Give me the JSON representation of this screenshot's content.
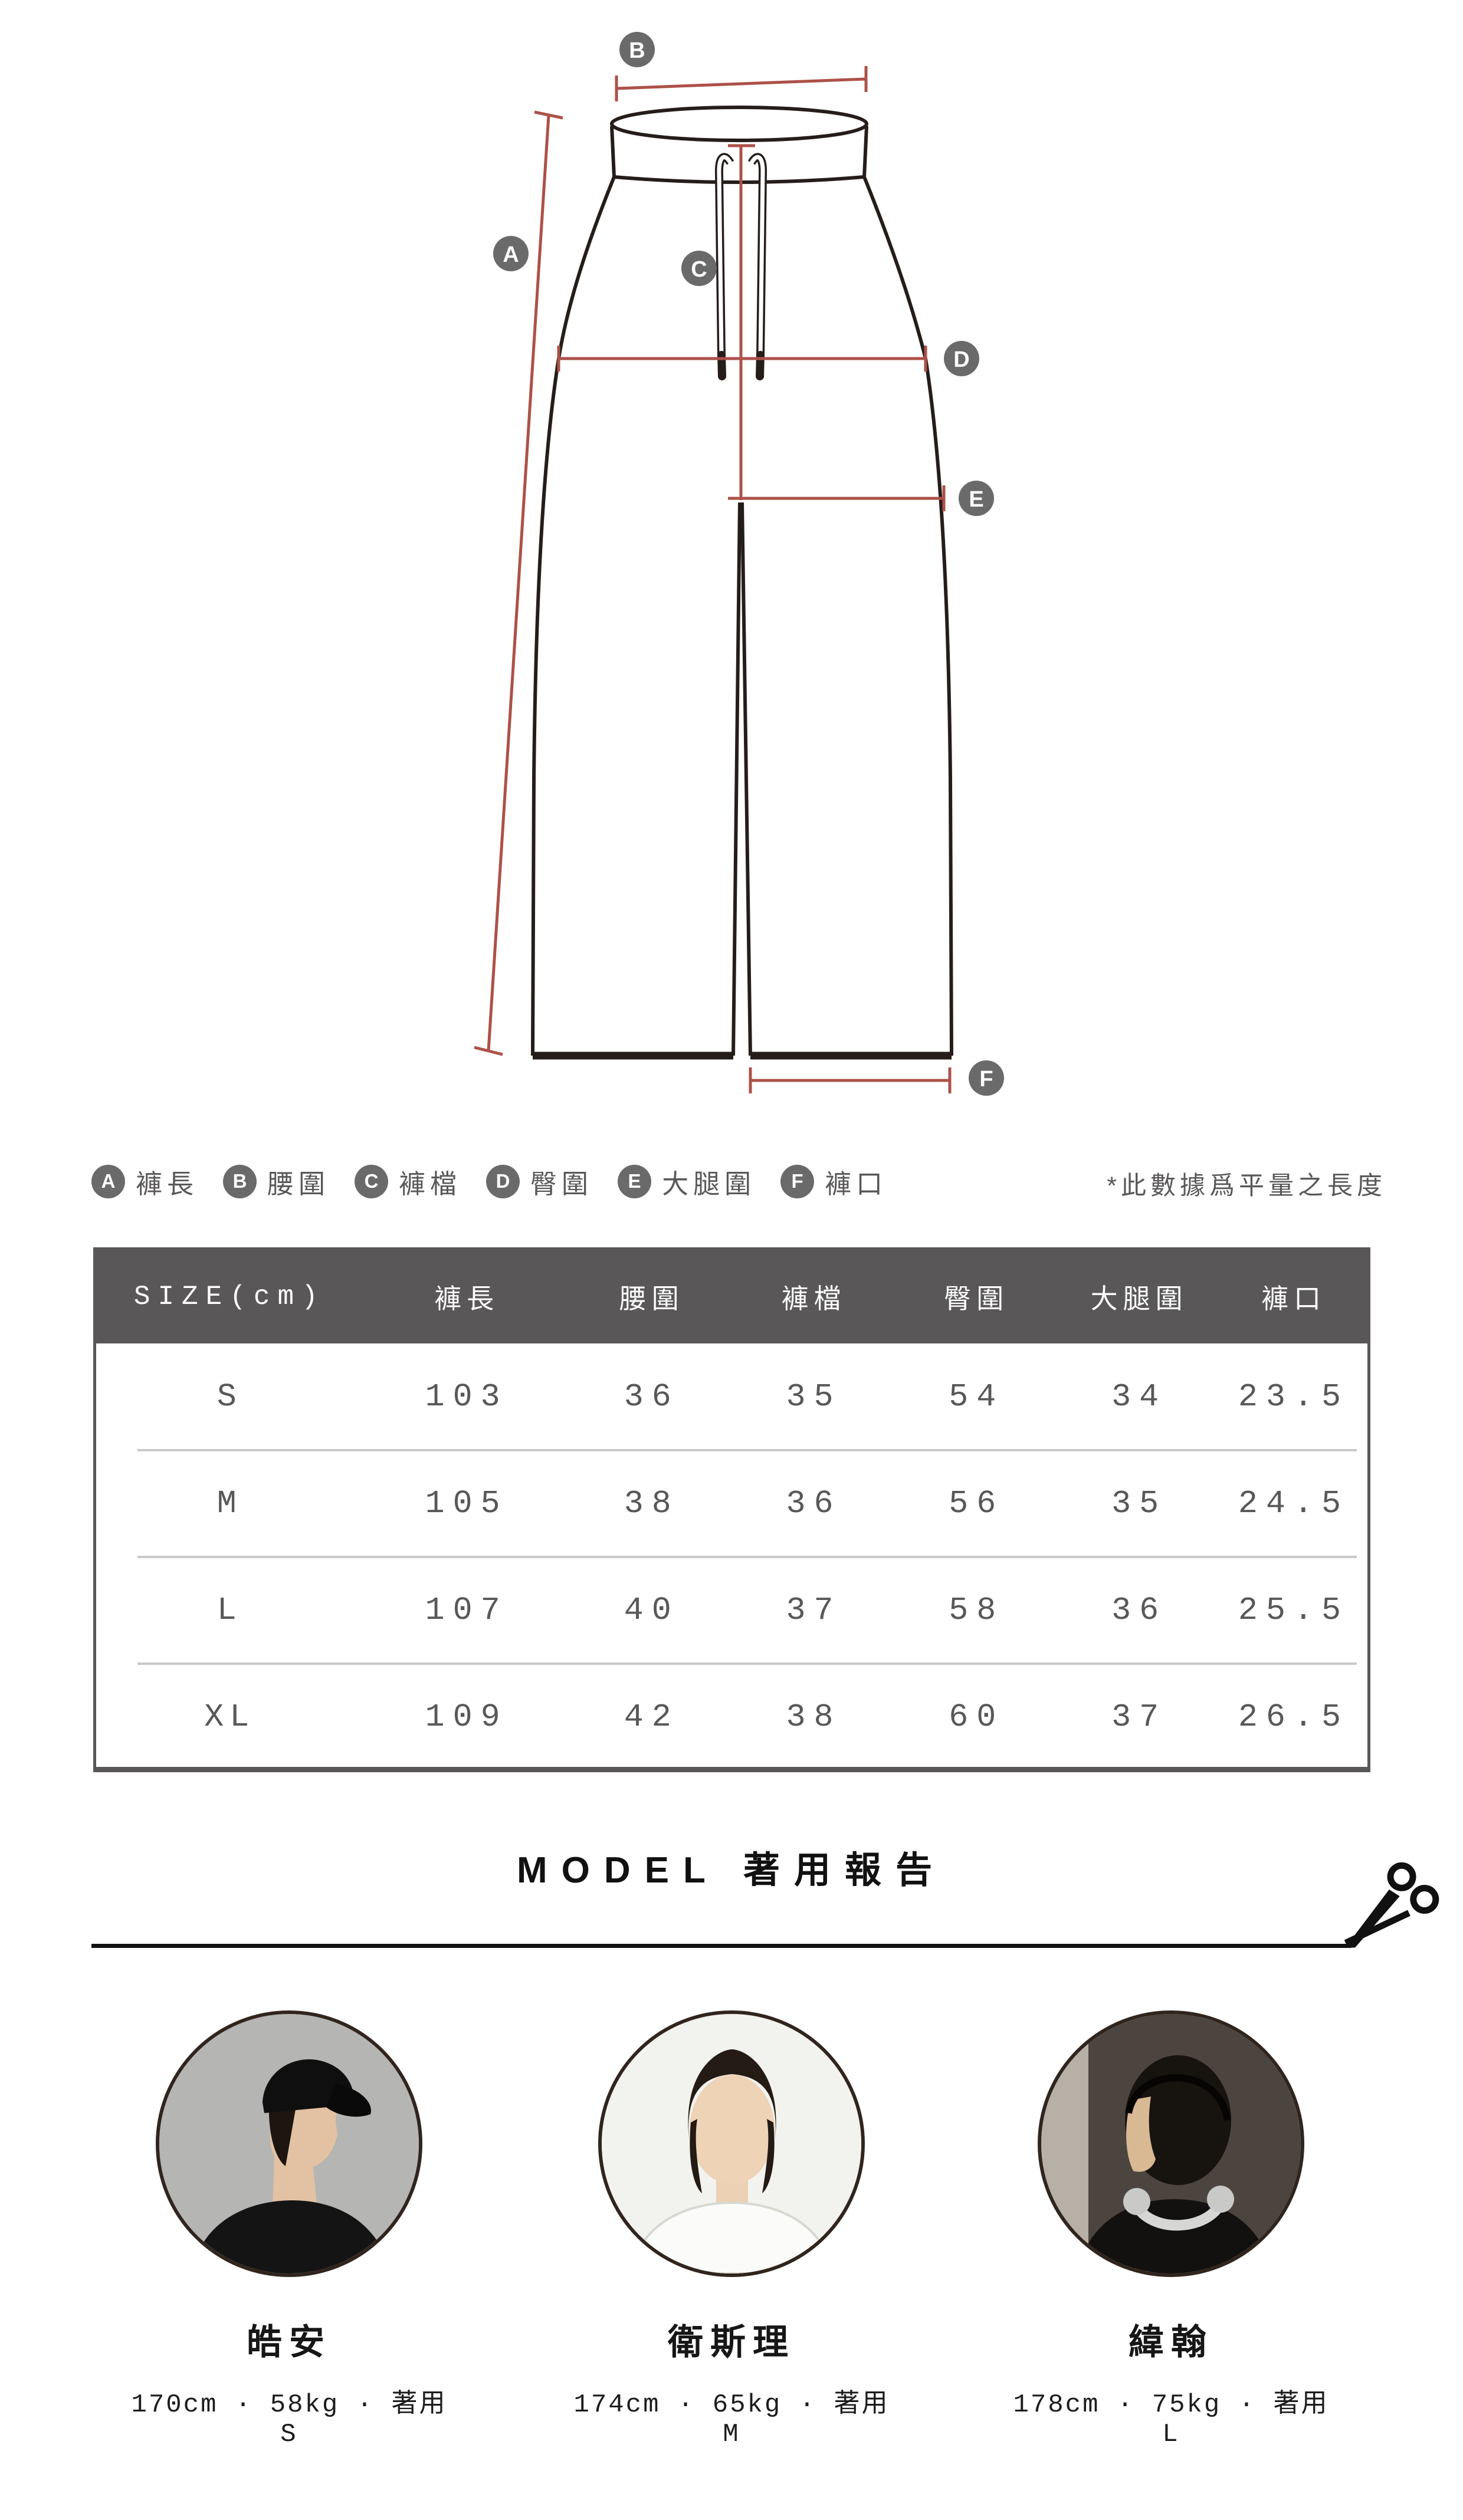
{
  "colors": {
    "accent_red": "#ad5149",
    "outline": "#251d1a",
    "marker_gray": "#6a6a6a",
    "table_header_bg": "#595757",
    "table_border": "#595757",
    "text_gray": "#595757",
    "separator": "#c9c9c9",
    "title_black": "#111111"
  },
  "diagram": {
    "markers": [
      "A",
      "B",
      "C",
      "D",
      "E",
      "F"
    ]
  },
  "legend": {
    "items": [
      {
        "letter": "A",
        "label": "褲長"
      },
      {
        "letter": "B",
        "label": "腰圍"
      },
      {
        "letter": "C",
        "label": "褲檔"
      },
      {
        "letter": "D",
        "label": "臀圍"
      },
      {
        "letter": "E",
        "label": "大腿圍"
      },
      {
        "letter": "F",
        "label": "褲口"
      }
    ],
    "note": "*此數據爲平量之長度"
  },
  "size_table": {
    "unit_header": "SIZE(cm)",
    "columns": [
      "褲長",
      "腰圍",
      "褲檔",
      "臀圍",
      "大腿圍",
      "褲口"
    ],
    "rows": [
      {
        "size": "S",
        "values": [
          "103",
          "36",
          "35",
          "54",
          "34",
          "23.5"
        ]
      },
      {
        "size": "M",
        "values": [
          "105",
          "38",
          "36",
          "56",
          "35",
          "24.5"
        ]
      },
      {
        "size": "L",
        "values": [
          "107",
          "40",
          "37",
          "58",
          "36",
          "25.5"
        ]
      },
      {
        "size": "XL",
        "values": [
          "109",
          "42",
          "38",
          "60",
          "37",
          "26.5"
        ]
      }
    ]
  },
  "model_section": {
    "title": "MODEL 著用報告",
    "models": [
      {
        "name": "皓安",
        "stats": "170cm · 58kg · 著用S"
      },
      {
        "name": "衛斯理",
        "stats": "174cm · 65kg · 著用M"
      },
      {
        "name": "緯翰",
        "stats": "178cm · 75kg · 著用L"
      }
    ]
  }
}
